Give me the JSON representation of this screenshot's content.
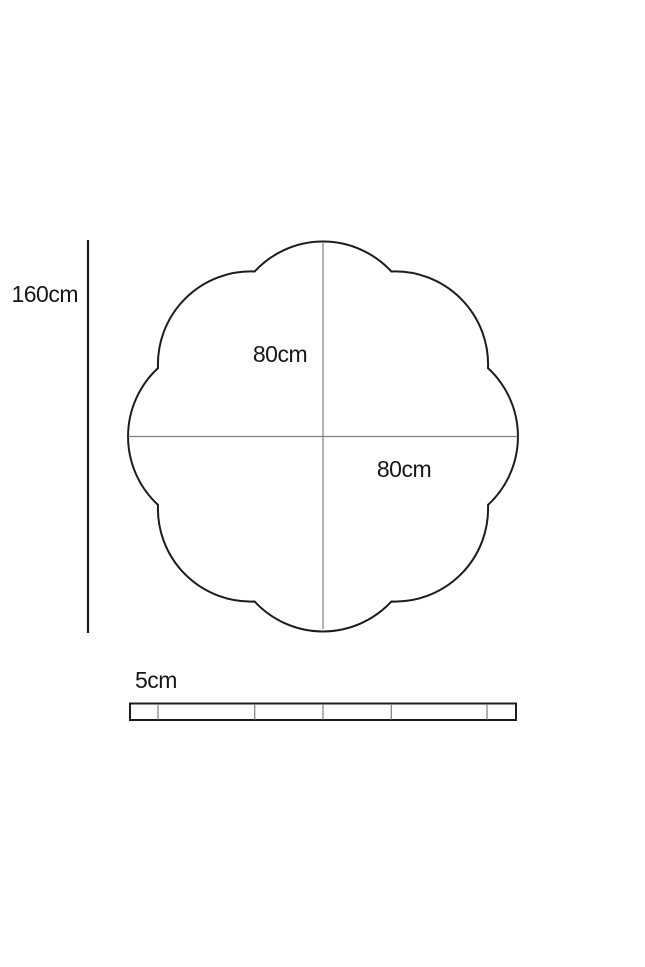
{
  "diagram": {
    "labels": {
      "height": "160cm",
      "radius_upper": "80cm",
      "radius_lower": "80cm",
      "thickness": "5cm"
    },
    "colors": {
      "outline": "#1c1c1c",
      "guide": "#7f7f7f",
      "background": "#ffffff"
    }
  }
}
